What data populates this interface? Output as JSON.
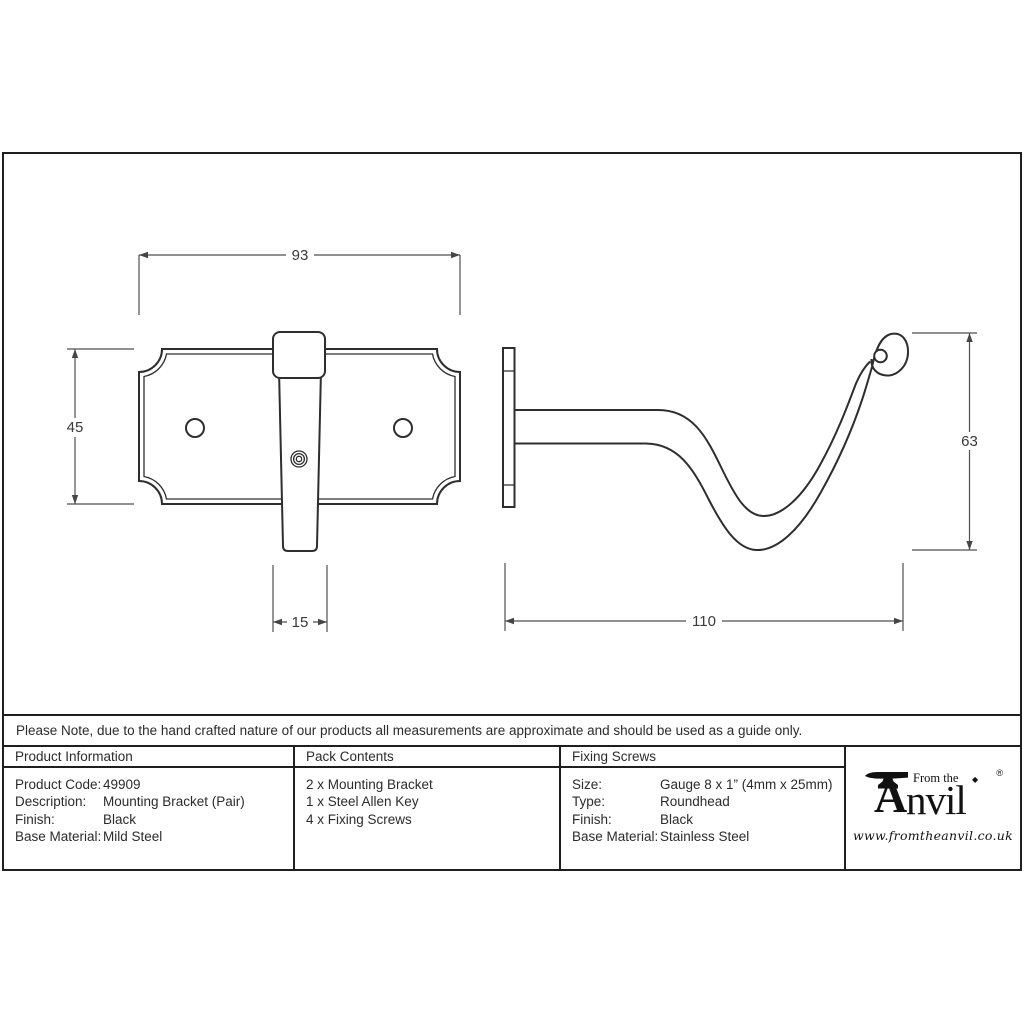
{
  "note": "Please Note, due to the hand crafted nature of our products all measurements are approximate and should be used as a guide only.",
  "drawing": {
    "front_view": {
      "width": "93",
      "height": "45",
      "bracket_width": "15"
    },
    "side_view": {
      "depth": "110",
      "hook_height": "63"
    }
  },
  "table": {
    "product_information": {
      "title": "Product Information",
      "rows": [
        {
          "label": "Product Code:",
          "value": "49909"
        },
        {
          "label": "Description:",
          "value": "Mounting Bracket (Pair)"
        },
        {
          "label": "Finish:",
          "value": "Black"
        },
        {
          "label": "Base Material:",
          "value": "Mild Steel"
        }
      ]
    },
    "pack_contents": {
      "title": "Pack Contents",
      "items": [
        "2 x Mounting Bracket",
        "1 x Steel Allen Key",
        "4 x Fixing Screws"
      ]
    },
    "fixing_screws": {
      "title": "Fixing Screws",
      "rows": [
        {
          "label": "Size:",
          "value": "Gauge 8 x 1” (4mm x 25mm)"
        },
        {
          "label": "Type:",
          "value": "Roundhead"
        },
        {
          "label": "Finish:",
          "value": "Black"
        },
        {
          "label": "Base Material:",
          "value": "Stainless Steel"
        }
      ]
    }
  },
  "logo": {
    "brand_initial": "A",
    "brand_rest": "nvil",
    "brand_prefix": "From the",
    "diamond": "◆",
    "registered": "®",
    "website": "www.fromtheanvil.co.uk"
  }
}
